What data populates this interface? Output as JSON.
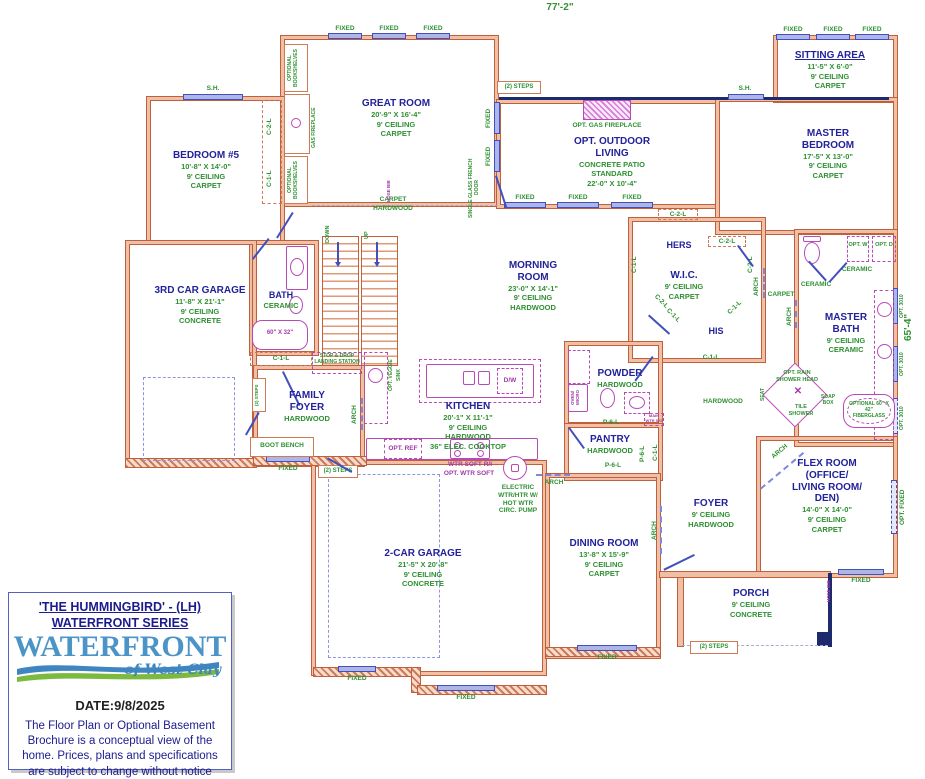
{
  "dimensions": {
    "width_top": "77'-2\"",
    "height_right": "65'-4\""
  },
  "rooms": {
    "great_room": {
      "name": "GREAT ROOM",
      "size": "20'-9\" X 16'-4\"",
      "ceiling": "9' CEILING",
      "floor": "CARPET"
    },
    "bedroom5": {
      "name": "BEDROOM #5",
      "size": "10'-8\" X 14'-0\"",
      "ceiling": "9' CEILING",
      "floor": "CARPET"
    },
    "sitting": {
      "name": "SITTING AREA",
      "size": "11'-5\" X 6'-0\"",
      "ceiling": "9' CEILING",
      "floor": "CARPET"
    },
    "master_bedroom": {
      "name": "MASTER BEDROOM",
      "size": "17'-5\" X 13'-0\"",
      "ceiling": "9' CEILING",
      "floor": "CARPET"
    },
    "outdoor_living": {
      "name": "OPT. OUTDOOR LIVING",
      "note": "CONCRETE PATIO STANDARD",
      "size": "22'-0\" X 10'-4\""
    },
    "morning": {
      "name": "MORNING ROOM",
      "size": "23'-0\" X 14'-1\"",
      "ceiling": "9' CEILING",
      "floor": "HARDWOOD"
    },
    "kitchen": {
      "name": "KITCHEN",
      "size": "20'-1\" X 11'-1\"",
      "ceiling": "9' CEILING",
      "floor": "HARDWOOD",
      "extra": "36\" ELEC. COOKTOP"
    },
    "garage3": {
      "name": "3RD CAR GARAGE",
      "size": "11'-8\" X 21'-1\"",
      "ceiling": "9' CEILING",
      "floor": "CONCRETE"
    },
    "bath": {
      "name": "BATH",
      "floor": "CERAMIC"
    },
    "family_foyer": {
      "name": "FAMILY FOYER",
      "floor": "HARDWOOD"
    },
    "wic": {
      "name": "W.I.C.",
      "ceiling": "9' CEILING",
      "floor": "CARPET",
      "hers": "HERS",
      "his": "HIS"
    },
    "master_bath": {
      "name": "MASTER BATH",
      "ceiling": "9' CEILING",
      "floor": "CERAMIC"
    },
    "powder": {
      "name": "POWDER",
      "floor": "HARDWOOD"
    },
    "pantry": {
      "name": "PANTRY",
      "floor": "HARDWOOD"
    },
    "dining": {
      "name": "DINING ROOM",
      "size": "13'-8\" X 15'-9\"",
      "ceiling": "9' CEILING",
      "floor": "CARPET"
    },
    "foyer": {
      "name": "FOYER",
      "ceiling": "9' CEILING",
      "floor": "HARDWOOD"
    },
    "garage2": {
      "name": "2-CAR GARAGE",
      "size": "21'-5\" X 20'-8\"",
      "ceiling": "9' CEILING",
      "floor": "CONCRETE"
    },
    "flex": {
      "name": "FLEX ROOM (OFFICE/ LIVING ROOM/ DEN)",
      "size": "14'-0\" X 14'-0\"",
      "ceiling": "9' CEILING",
      "floor": "CARPET"
    },
    "porch": {
      "name": "PORCH",
      "ceiling": "9' CEILING",
      "floor": "CONCRETE"
    }
  },
  "labels": {
    "fixed": "FIXED",
    "sh": "S.H.",
    "steps2": "(2) STEPS",
    "arch": "ARCH",
    "carpet": "CARPET",
    "hardwood": "HARDWOOD",
    "ceramic": "CERAMIC",
    "c1l": "C-1-L",
    "c2l": "C-2-L",
    "p6l": "P-6-L",
    "opt_bookshelves": "OPTIONAL BOOKSHELVES",
    "gas_fireplace": "GAS FIREPLACE",
    "opt_gas_fireplace": "OPT. GAS FIREPLACE",
    "french_door": "SINGLE GLASS FRENCH DOOR",
    "hose_bib": "HOSE BIB",
    "down": "DOWN",
    "up": "UP",
    "stop_drop": "STOP & DROP LANDING STATION",
    "veggie": "OPT. VEGGIE",
    "sink": "SINK",
    "boot_bench": "BOOT BENCH",
    "opt_ref": "OPT. REF",
    "dw": "D/W",
    "oven_micro": "OVEN/ MICRO",
    "tub_size": "60\" X 32\"",
    "wtr_soft": "WTR SOFT R/I",
    "opt_wtr_soft": "OPT. WTR SOFT",
    "wtr_htr": "ELECTRIC WTR/HTR W/ HOT WTR CIRC. PUMP",
    "opt_w": "OPT. W",
    "opt_d": "OPT. D",
    "opt_3010": "OPT. 3010",
    "opt_fixed": "OPT. FIXED",
    "rain_shower": "OPT. RAIN SHOWER HEAD",
    "tile_shower": "TILE SHOWER",
    "seat": "SEAT",
    "soap_box": "SOAP BOX",
    "opt_tub": "OPTIONAL 60\" X 42\" FIBERGLASS",
    "main_shutoff": "MAIN WTR S/O"
  },
  "title_block": {
    "plan_name": "'THE HUMMINGBIRD' - (LH)",
    "series": "WATERFRONT SERIES",
    "logo_main": "WATERFRONT",
    "logo_sub": "of West Clay",
    "date": "DATE:9/8/2025",
    "disclaimer": "The Floor Plan or Optional Basement Brochure is a conceptual view of the home.  Prices, plans and specifications are subject to change without notice"
  }
}
